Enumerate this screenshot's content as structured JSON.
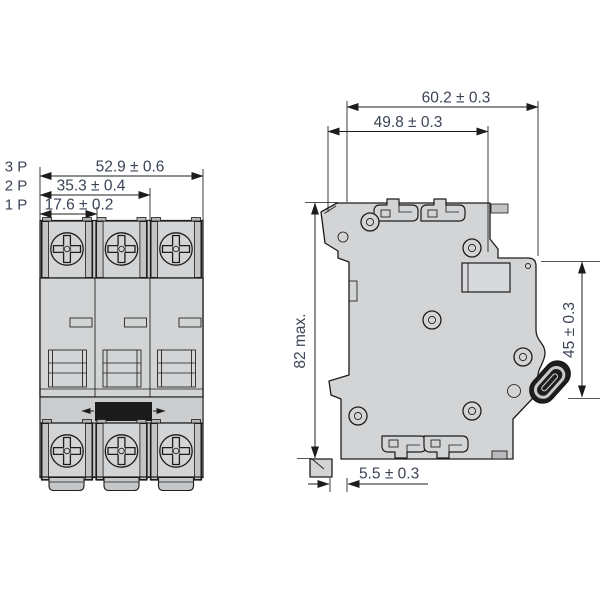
{
  "drawing": {
    "kind": "dimensional drawing – modular circuit breaker, front and side views",
    "front_view": {
      "rows": [
        {
          "pole_label": "3 P",
          "dimension": "52.9 ± 0.6"
        },
        {
          "pole_label": "2 P",
          "dimension": "35.3 ± 0.4"
        },
        {
          "pole_label": "1 P",
          "dimension": "17.6 ± 0.2"
        }
      ]
    },
    "side_view": {
      "dim_total_depth": "60.2 ± 0.3",
      "dim_body_depth": "49.8 ± 0.3",
      "dim_height": "82 max.",
      "dim_front_height": "45 ± 0.3",
      "dim_clip_offset": "5.5 ± 0.3"
    },
    "colors": {
      "background": "#ffffff",
      "body_fill": "#d3d4d6",
      "body_shade": "#c3c4c6",
      "outline": "#1c1c1c",
      "dimension_text": "#3a4456",
      "toggle_handle": "#1b1b1b"
    }
  }
}
